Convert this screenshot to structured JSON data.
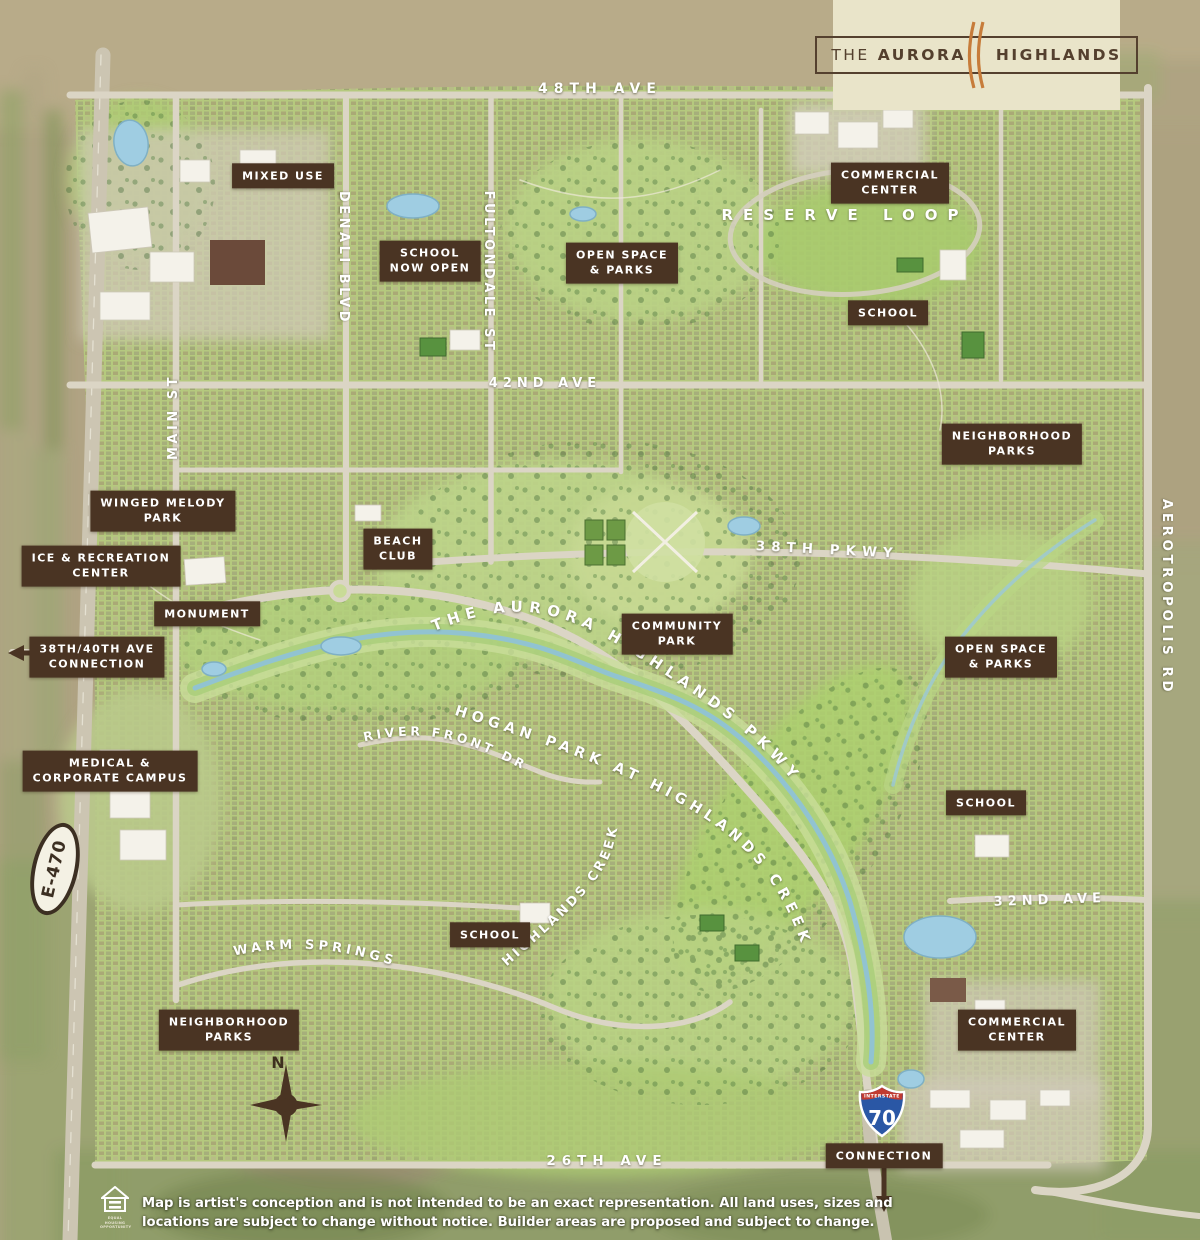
{
  "logo": {
    "word1": "THE",
    "word2": "AURORA",
    "word3": "HIGHLANDS"
  },
  "streets": {
    "ave48": "48TH AVE",
    "ave42": "42ND AVE",
    "ave32": "32ND AVE",
    "ave26": "26TH AVE",
    "pkwy38": "38TH PKWY",
    "reserve_loop": "RESERVE LOOP",
    "denali": "DENALI BLVD",
    "fultondale": "FULTONDALE ST",
    "main_st": "MAIN ST",
    "aerotropolis": "AEROTROPOLIS RD",
    "aurora_pkwy": "THE AURORA HIGHLANDS PKWY",
    "hogan_park": "HOGAN PARK AT HIGHLANDS CREEK",
    "highlands_creek": "HIGHLANDS CREEK",
    "river_front": "RIVER FRONT DR",
    "warm_springs": "WARM SPRINGS",
    "e470": "E-470"
  },
  "badges": {
    "interstate": "INTERSTATE",
    "i70": "70"
  },
  "labels": {
    "mixed_use": {
      "l1": "MIXED USE",
      "l2": ""
    },
    "school_now_open": {
      "l1": "SCHOOL",
      "l2": "NOW OPEN"
    },
    "open_space_top": {
      "l1": "OPEN SPACE",
      "l2": "& PARKS"
    },
    "commercial_top": {
      "l1": "COMMERCIAL",
      "l2": "CENTER"
    },
    "school_ne": {
      "l1": "SCHOOL",
      "l2": ""
    },
    "neighborhood_e": {
      "l1": "NEIGHBORHOOD",
      "l2": "PARKS"
    },
    "winged_melody": {
      "l1": "WINGED MELODY",
      "l2": "PARK"
    },
    "ice_rec": {
      "l1": "ICE & RECREATION",
      "l2": "CENTER"
    },
    "monument": {
      "l1": "MONUMENT",
      "l2": ""
    },
    "ave_connection": {
      "l1": "38TH/40TH AVE",
      "l2": "CONNECTION"
    },
    "beach_club": {
      "l1": "BEACH",
      "l2": "CLUB"
    },
    "community_park": {
      "l1": "COMMUNITY",
      "l2": "PARK"
    },
    "open_space_e": {
      "l1": "OPEN SPACE",
      "l2": "& PARKS"
    },
    "medical": {
      "l1": "MEDICAL &",
      "l2": "CORPORATE CAMPUS"
    },
    "school_e": {
      "l1": "SCHOOL",
      "l2": ""
    },
    "school_s": {
      "l1": "SCHOOL",
      "l2": ""
    },
    "neighborhood_sw": {
      "l1": "NEIGHBORHOOD",
      "l2": "PARKS"
    },
    "commercial_s": {
      "l1": "COMMERCIAL",
      "l2": "CENTER"
    },
    "connection_i70": {
      "l1": "CONNECTION",
      "l2": ""
    }
  },
  "compass": {
    "north": "N"
  },
  "footer": {
    "line1": "Map is artist's conception and is not intended to be an exact representation. All land uses, sizes and",
    "line2": "locations are subject to change without notice. Builder areas are proposed and subject to change.",
    "eh_cap1": "EQUAL HOUSING",
    "eh_cap2": "OPPORTUNITY"
  },
  "colors": {
    "label_brown": "#4a3423",
    "logo_cream": "#e9e4c9",
    "logo_brown": "#54402e",
    "slash_orange": "#c77c3a",
    "community_green": "#b6cb7e",
    "field_tan": "#b0a383",
    "road_gray": "#dbd5c5",
    "creek_blue": "#8fc3d6",
    "shield_blue": "#2a57a5",
    "shield_red": "#c13b31"
  }
}
